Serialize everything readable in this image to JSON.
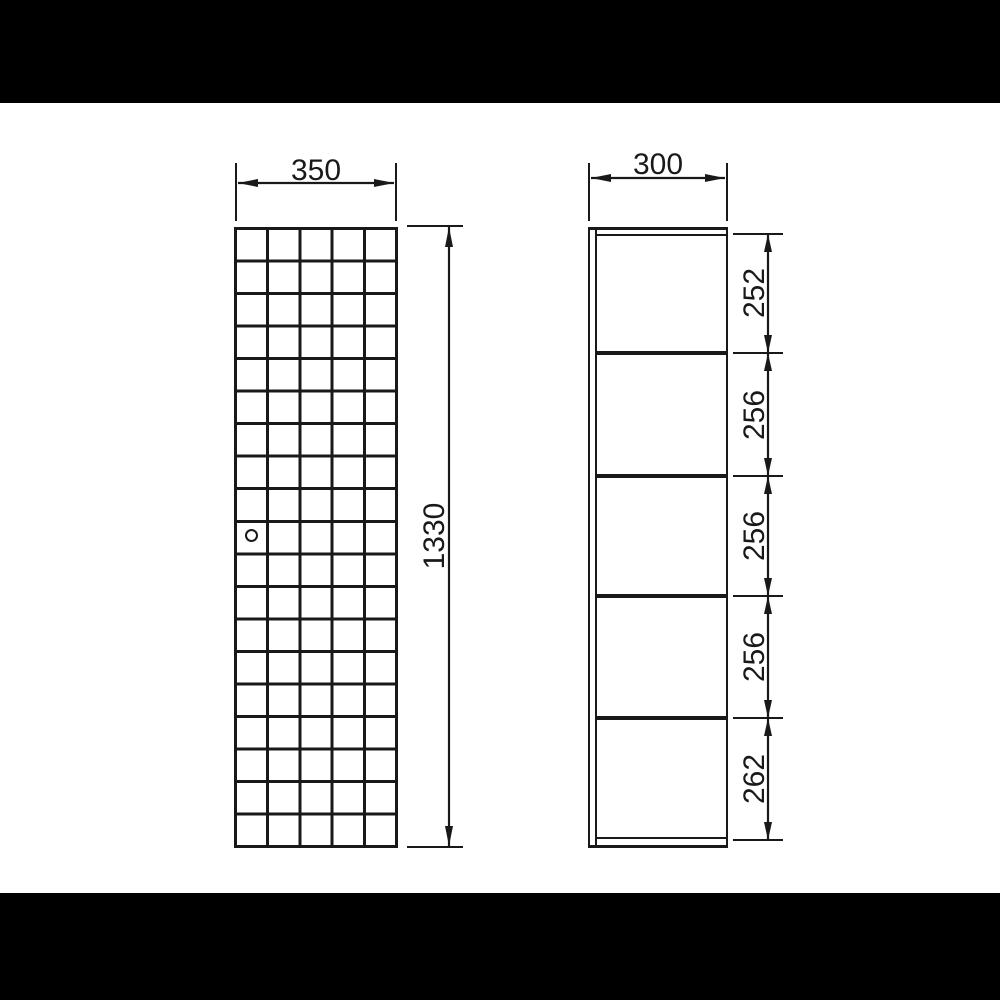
{
  "front_view": {
    "width_dim": "350",
    "height_dim": "1330",
    "grid_columns": 5,
    "grid_rows": 19
  },
  "side_view": {
    "width_dim": "300",
    "section_dims": [
      "252",
      "256",
      "256",
      "256",
      "262"
    ]
  },
  "colors": {
    "line": "#191919",
    "canvas": "#ffffff",
    "letterbox": "#000000"
  }
}
